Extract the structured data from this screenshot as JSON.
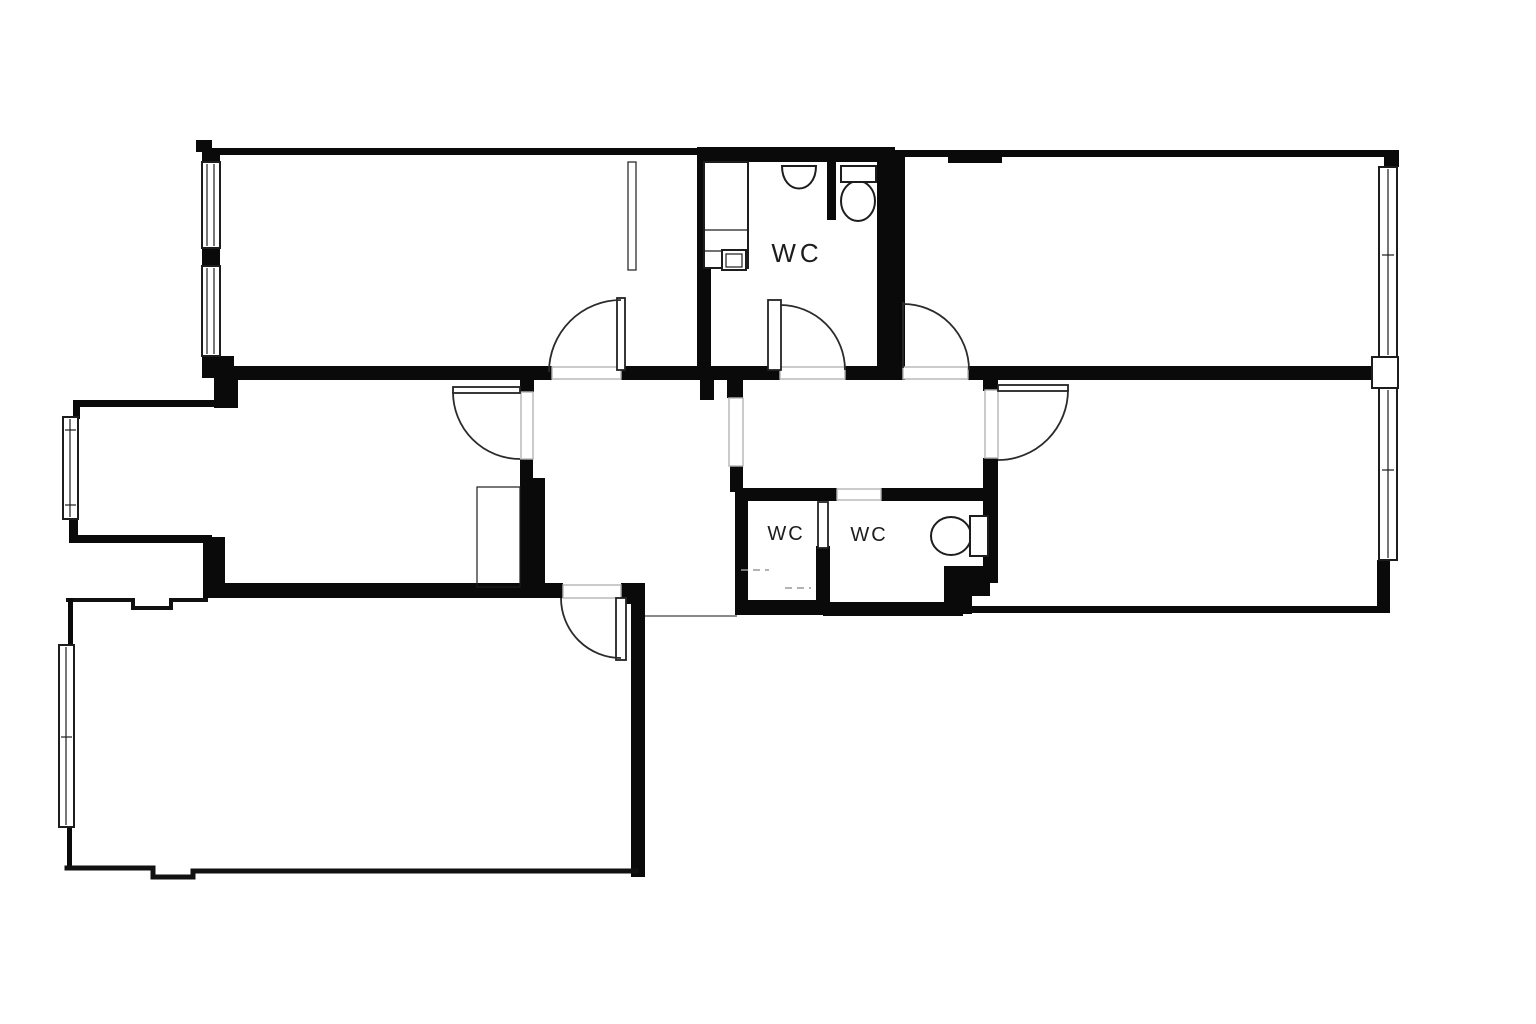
{
  "labels": {
    "wc_top": "WC",
    "wc_left": "WC",
    "wc_right": "WC"
  },
  "colors": {
    "background": "#ffffff",
    "wall": "#0a0a0a",
    "line": "#1d1d1d",
    "door_arc": "#2b2b2b",
    "threshold": "#b5b5b5",
    "text": "#1c1c1c"
  },
  "icons": [
    "sink-icon",
    "toilet-icon-top-wc",
    "toilet-icon-right-wc",
    "cabinet-icon",
    "washing-machine-icon",
    "wardrobe-icon",
    "closet-icon"
  ],
  "counts": {
    "door_swings": 6,
    "windows": 6,
    "wc_labels": 3
  }
}
